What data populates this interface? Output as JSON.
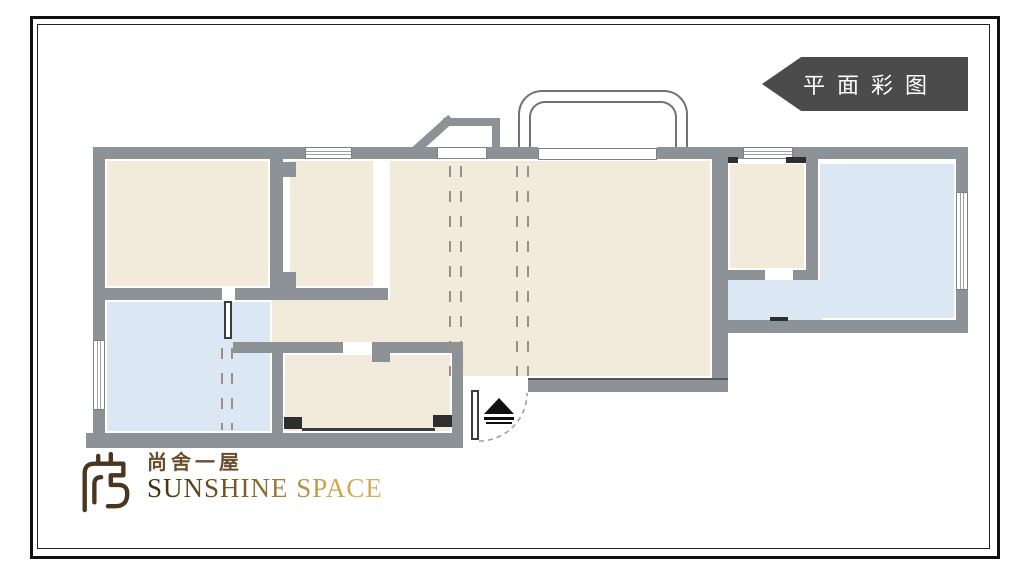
{
  "stamp": {
    "label": "平面彩图"
  },
  "logo": {
    "name_cn": "尚舍一屋",
    "name_en": "SUNSHINE SPACE"
  },
  "palette": {
    "wall_gray": "#8d9296",
    "room_warm_beige": "#f2ebdb",
    "room_cool_blue": "#dbe7f2",
    "stamp_background": "#4b4b4b",
    "stamp_text": "#ffffff",
    "logo_brown": "#6a4c2a",
    "logo_gold": "#c8a24e"
  },
  "floorplan": {
    "type": "residential-floor-plan",
    "rooms": [
      {
        "id": "bedroom-top-left",
        "fill": "warm"
      },
      {
        "id": "bedroom-second",
        "fill": "warm"
      },
      {
        "id": "living-dining-hall",
        "fill": "warm"
      },
      {
        "id": "hallway",
        "fill": "warm"
      },
      {
        "id": "room-top-right",
        "fill": "warm"
      },
      {
        "id": "bathroom-right",
        "fill": "cool"
      },
      {
        "id": "room-bottom-left",
        "fill": "cool"
      },
      {
        "id": "room-bottom-middle",
        "fill": "warm"
      }
    ],
    "features": [
      "bay-window-top",
      "angled-bump-out",
      "entry-door-swing-arc",
      "entrance-triangle-marker",
      "sliding-track-dashed-lines",
      "windows-on-all-sides"
    ]
  }
}
